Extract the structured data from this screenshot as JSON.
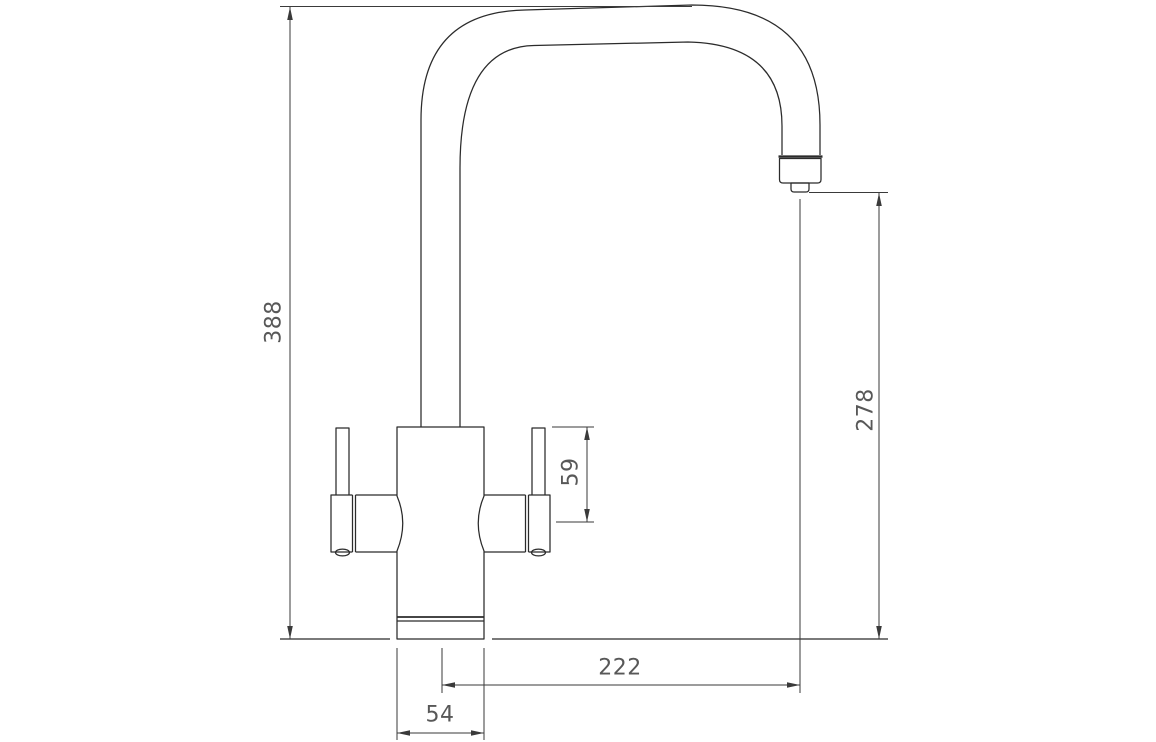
{
  "drawing": {
    "type": "technical-dimension-drawing",
    "subject": "twin-lever kitchen mixer tap, front elevation",
    "colors": {
      "line": "#2b2b2b",
      "dim": "#3a3a3a",
      "text": "#585858",
      "background": "#ffffff"
    },
    "dimensions": {
      "overall_height": {
        "value": "388",
        "orientation": "vertical",
        "location": "left",
        "measures": "counter top to top of spout"
      },
      "spout_clearance": {
        "value": "278",
        "orientation": "vertical",
        "location": "right",
        "measures": "counter top to spout outlet"
      },
      "handle_height": {
        "value": "59",
        "orientation": "vertical",
        "location": "beside right handle",
        "measures": "handle lever top to handle axis"
      },
      "spout_reach": {
        "value": "222",
        "orientation": "horizontal",
        "location": "bottom right",
        "measures": "tap centre to spout outlet centre"
      },
      "base_width": {
        "value": "54",
        "orientation": "horizontal",
        "location": "bottom",
        "measures": "base diameter"
      }
    }
  }
}
